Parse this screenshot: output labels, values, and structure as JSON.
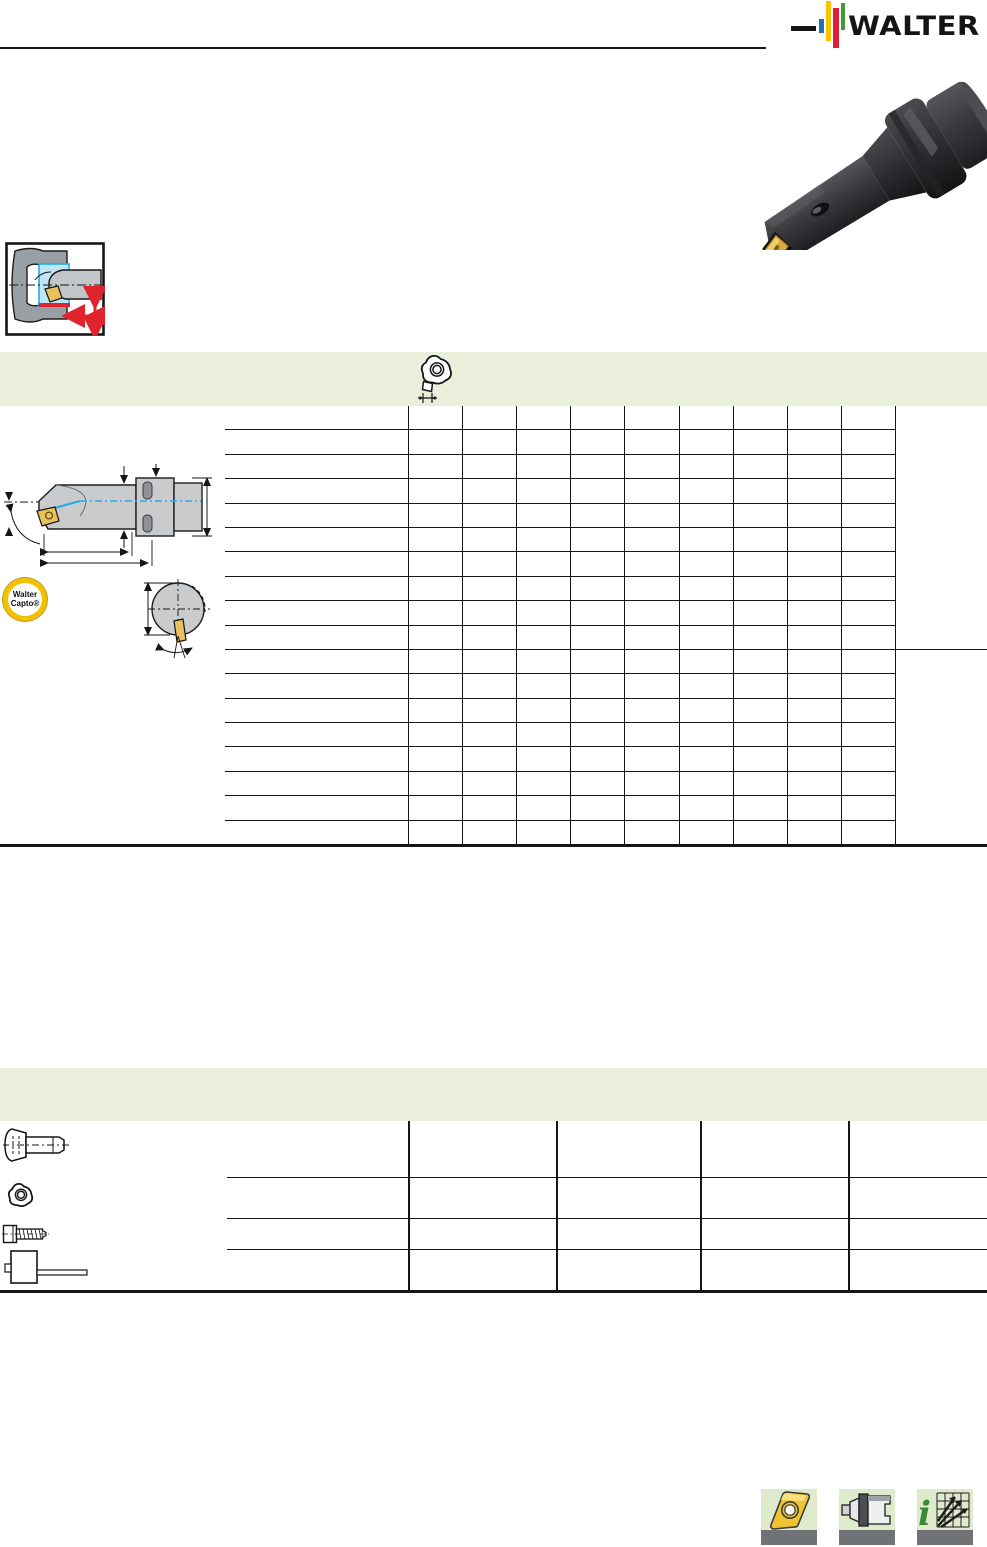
{
  "brand": {
    "logo_text": "WALTER",
    "colors": {
      "blue": "#2170b8",
      "yellow": "#fcc200",
      "red": "#e01f3d",
      "green": "#3f9c35",
      "black": "#161616"
    }
  },
  "capto_logo": {
    "line1": "Walter",
    "line2": "Capto®"
  },
  "product_photo": {
    "name": "boring-bar-with-capto-shank-photo"
  },
  "application_icon": {
    "name": "internal-turning-application-pictogram"
  },
  "section1": {
    "band_color": "#e9efda",
    "insert_icon": "trigon-insert-top-view-with-thickness-dimension",
    "table": {
      "rows_group_a": 10,
      "rows_group_b": 8,
      "data_columns": 9,
      "cells_empty": true
    }
  },
  "technical_drawings": {
    "side_view": "boring-bar-side-view-with-dimensions-and-coolant-channel",
    "end_view": "boring-bar-end-view-with-insert-and-angle-dimension"
  },
  "section2": {
    "band_color": "#e9efda",
    "columns": 4,
    "rows": [
      {
        "icon": "clamping-screw"
      },
      {
        "icon": "indexable-trigon-insert"
      },
      {
        "icon": "torx-screw"
      },
      {
        "icon": "torque-wrench"
      }
    ]
  },
  "footer_icons": [
    {
      "name": "insert-tile-icon"
    },
    {
      "name": "adaptor-tile-icon"
    },
    {
      "name": "cutting-data-info-tile-icon"
    }
  ],
  "palette": {
    "band": "#e9efda",
    "tile": "#dfe9cb",
    "tile_bar": "#717276",
    "gold": "#e9c25f",
    "steel_gray": "#c9cbcc",
    "cyan": "#29abe2",
    "red": "#e0242e"
  }
}
